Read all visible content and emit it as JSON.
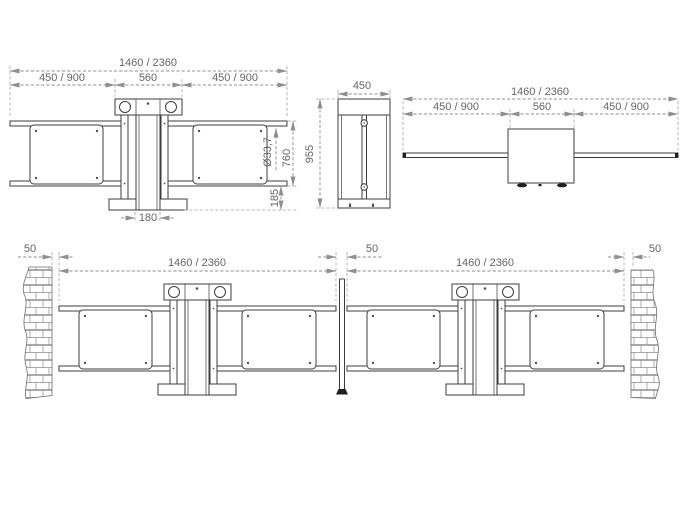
{
  "drawing": {
    "front_view": {
      "overall": "1460 / 2360",
      "left_section": "450 / 900",
      "center_section": "560",
      "right_section": "450 / 900",
      "tube_diameter": "Ø33,7",
      "rail_height": "760",
      "ground_clearance": "185",
      "base_width": "180"
    },
    "side_view": {
      "width": "450",
      "height": "955"
    },
    "plan_view": {
      "overall": "1460 / 2360",
      "left_section": "450 / 900",
      "center_section": "560",
      "right_section": "450 / 900"
    },
    "installation_view": {
      "wall_gap_left": "50",
      "gate1_width": "1460 / 2360",
      "center_gap": "50",
      "gate2_width": "1460 / 2360",
      "wall_gap_right": "50"
    },
    "colors": {
      "object_line": "#3c3c3c",
      "dimension_line": "#8f8f8f",
      "text": "#666666",
      "dark_fill": "#1f1f1f",
      "background": "#ffffff"
    }
  }
}
